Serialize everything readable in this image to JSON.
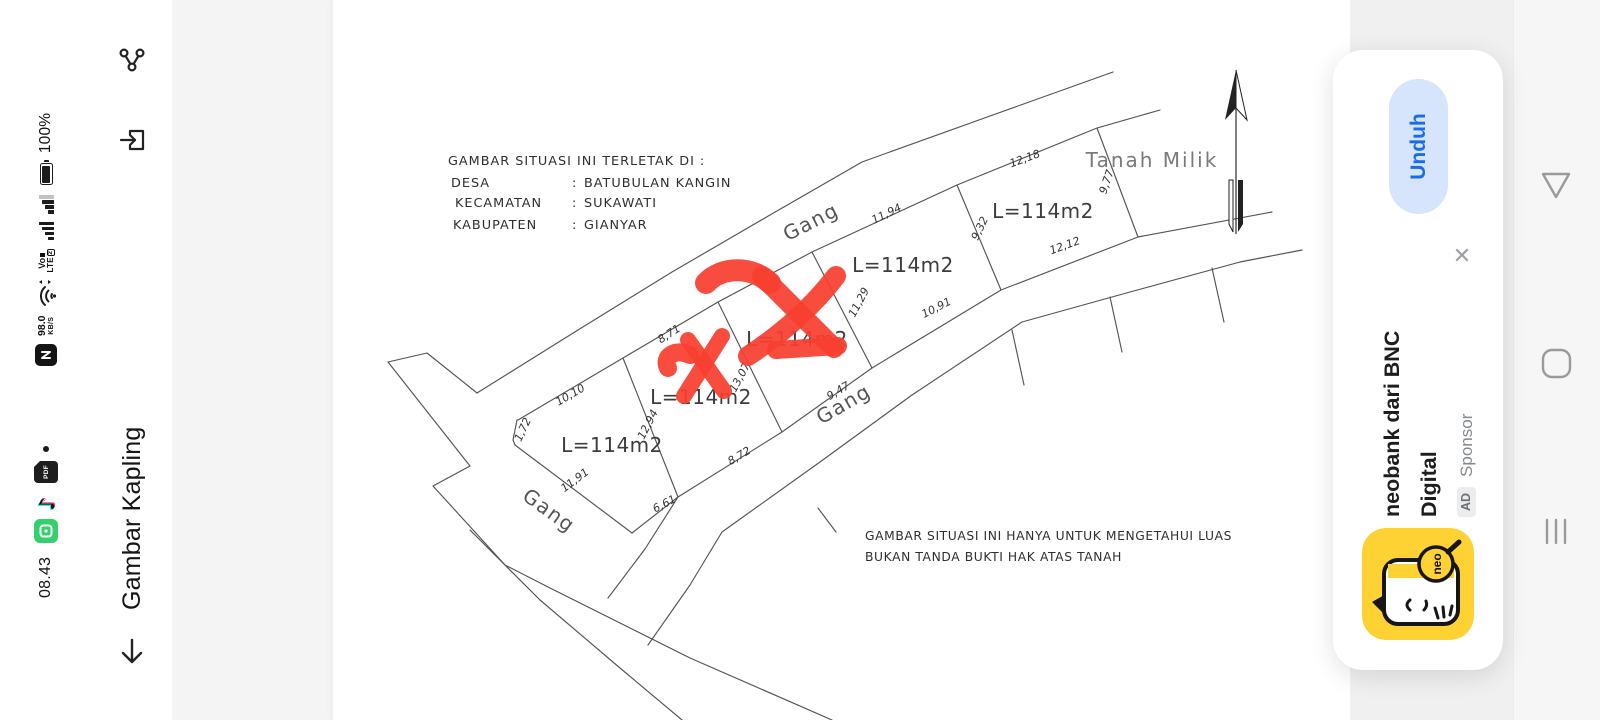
{
  "status_bar": {
    "time": "08.43",
    "battery_percent": "100%",
    "net_speed": "98.0",
    "net_speed_unit": "KB/S",
    "volte_top": "Vo",
    "volte_bottom": "LTE",
    "sim_badge": "2"
  },
  "header": {
    "title": "Gambar Kapling"
  },
  "viewer": {
    "drawing": {
      "location": {
        "title": "GAMBAR SITUASI INI TERLETAK DI :",
        "sep": ":",
        "rows": [
          {
            "label": "DESA",
            "value": "BATUBULAN KANGIN"
          },
          {
            "label": "KECAMATAN",
            "value": "SUKAWATI"
          },
          {
            "label": "KABUPATEN",
            "value": "GIANYAR"
          }
        ]
      },
      "road_labels": [
        "Gang",
        "Gang",
        "Gang"
      ],
      "plots": [
        {
          "area": "L=114m2"
        },
        {
          "area": "L=114m2"
        },
        {
          "area": "L=114m2"
        },
        {
          "area": "L=114m2"
        },
        {
          "area": "L=114m2"
        }
      ],
      "adjacent_label": "Tanah Milik",
      "measurements": [
        "10,10",
        "1,72",
        "12,94",
        "11,91",
        "6,61",
        "8,71",
        "13,07",
        "8,72",
        "11,29",
        "9,47",
        "11,94",
        "10,91",
        "9,32",
        "12,18",
        "9,77",
        "12,12"
      ],
      "disclaimer_line1": "GAMBAR SITUASI INI HANYA UNTUK MENGETAHUI LUAS",
      "disclaimer_line2": "BUKAN TANDA BUKTI HAK ATAS TANAH"
    }
  },
  "ad_card": {
    "cta_label": "Unduh",
    "close_glyph": "✕",
    "title_line1": "neobank dari BNC",
    "title_line2": "Digital",
    "ad_badge": "AD",
    "sponsor_label": "Sponsor",
    "logo_text": "neo",
    "colors": {
      "cta_bg": "#d6e4fc",
      "cta_text": "#1a6ce8",
      "logo_bg": "#ffd233",
      "marker_red": "#f8402f"
    }
  }
}
